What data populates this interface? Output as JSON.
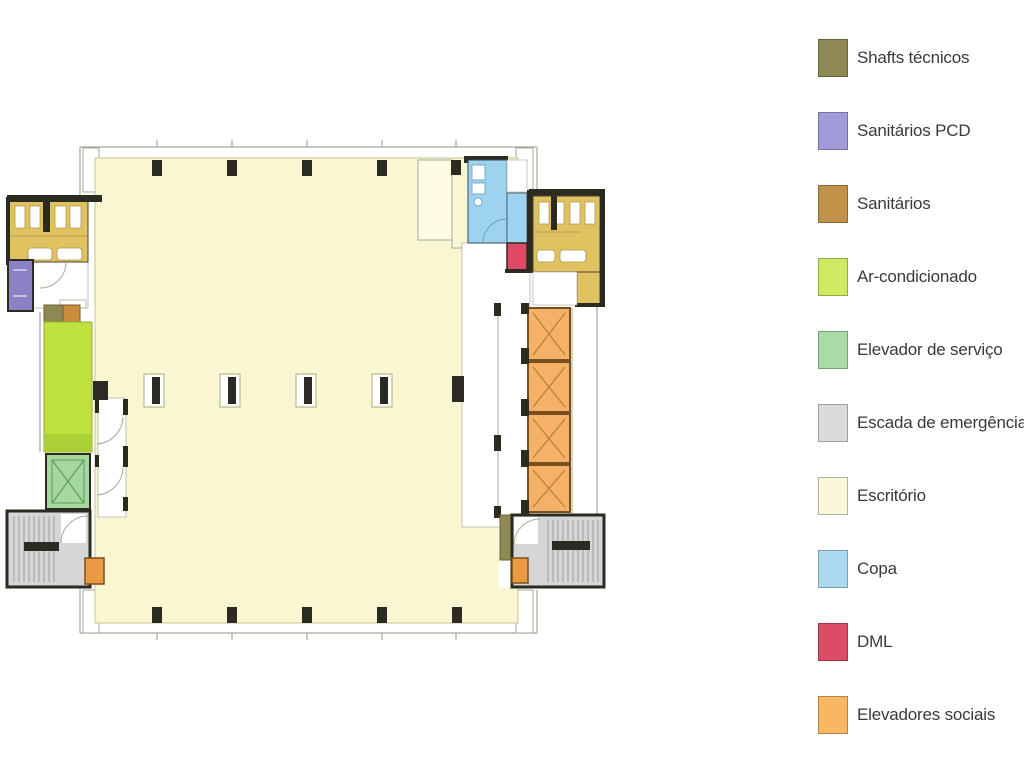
{
  "legend": {
    "items": [
      {
        "label": "Shafts técnicos",
        "color": "#8e8852"
      },
      {
        "label": "Sanitários PCD",
        "color": "#a29bd9"
      },
      {
        "label": "Sanitários",
        "color": "#c0924a"
      },
      {
        "label": "Ar-condicionado",
        "color": "#cdeb60"
      },
      {
        "label": "Elevador de serviço",
        "color": "#aadaa5"
      },
      {
        "label": "Escada de emergência",
        "color": "#dbdbdb"
      },
      {
        "label": "Escritório",
        "color": "#fbf8da"
      },
      {
        "label": "Copa",
        "color": "#abdaf0"
      },
      {
        "label": "DML",
        "color": "#dc4c66"
      },
      {
        "label": "Elevadores sociais",
        "color": "#f9b763"
      }
    ]
  },
  "plan": {
    "palette": {
      "wall": "#2b2b22",
      "faint": "#a8a89a",
      "escritorio": "#f9f6d2",
      "escritorio-border": "#c9c591",
      "sanit-room": "#e0c261",
      "pcd": "#8b82c6",
      "arcond": "#bfe23e",
      "arcond-band": "#a6cc35",
      "elevserv": "#a5d8a0",
      "elevserv-line": "#619c5c",
      "escada": "#d6d6d6",
      "tread": "#909090",
      "copa": "#9dd3ee",
      "copa-line": "#6a9ab8",
      "dml": "#dd4a64",
      "elevsoc": "#f5b167",
      "elevsoc-line": "#b5812f",
      "elevsoc-border": "#7a4f1e",
      "shafts": "#8e8852",
      "shaft-brown": "#c98c3c",
      "orange-box": "#ea9a40",
      "fixture-line": "#a8924a"
    }
  }
}
